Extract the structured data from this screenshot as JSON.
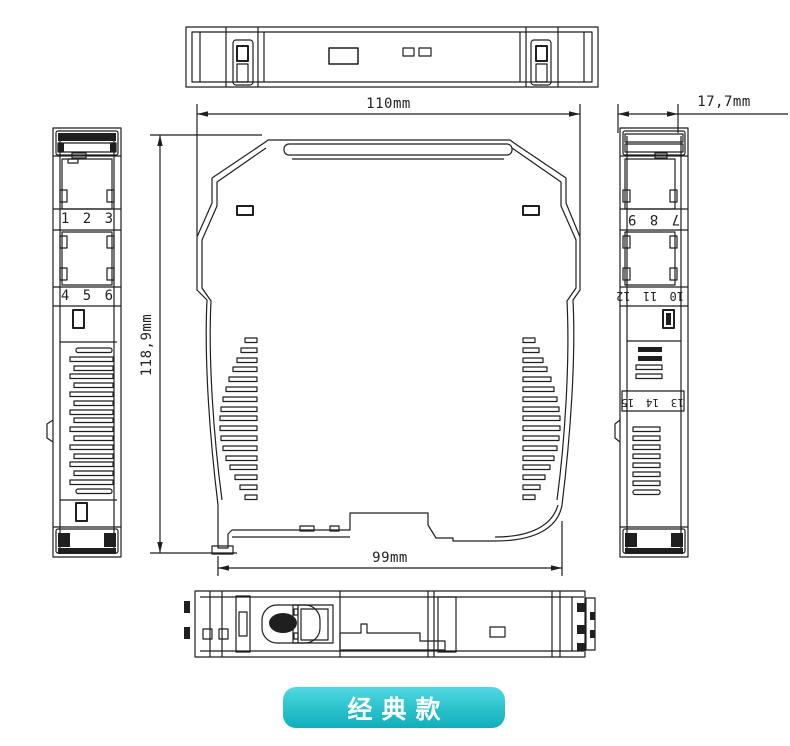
{
  "drawing": {
    "line_color": "#1f1f1f",
    "background": "#ffffff"
  },
  "dimensions": {
    "overall_width": "110mm",
    "depth": "17,7mm",
    "overall_height": "118,9mm",
    "base_width": "99mm"
  },
  "terminals": {
    "left_row1": "1 2 3",
    "left_row2": "4 5 6",
    "right_row1": "7 8 9",
    "right_row2": "10 11 12",
    "right_row3": "13 14 15"
  },
  "badge": {
    "label": "经典款",
    "text_color": "#ffffff",
    "gradient_top": "#52d8e0",
    "gradient_bottom": "#10aeba"
  }
}
